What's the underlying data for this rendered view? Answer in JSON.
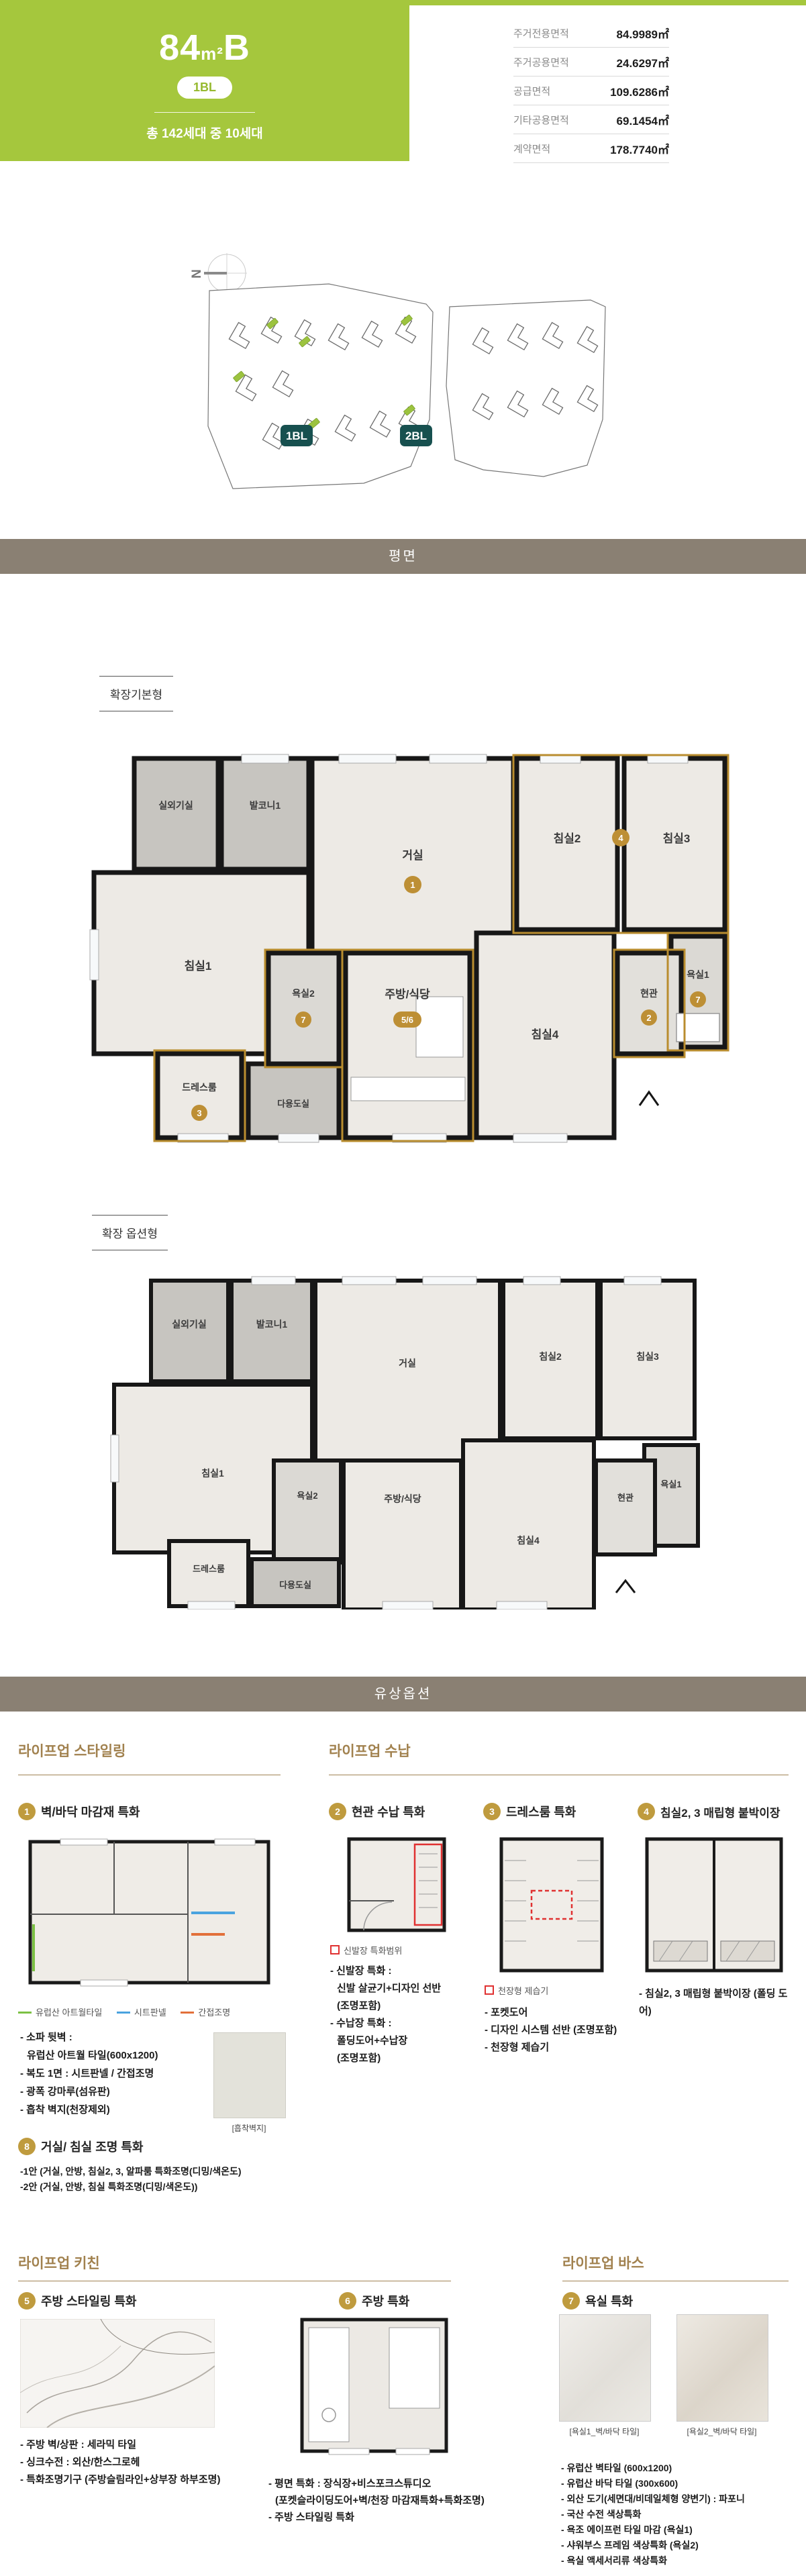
{
  "header": {
    "size": "84",
    "unit": "m²",
    "type": "B",
    "block_badge": "1BL",
    "units_text": "총 142세대 중 10세대",
    "area_table": [
      {
        "label": "주거전용면적",
        "value": "84.9989㎡"
      },
      {
        "label": "주거공용면적",
        "value": "24.6297㎡"
      },
      {
        "label": "공급면적",
        "value": "109.6286㎡"
      },
      {
        "label": "기타공용면적",
        "value": "69.1454㎡"
      },
      {
        "label": "계약면적",
        "value": "178.7740㎡"
      }
    ]
  },
  "site": {
    "north": "N",
    "block1": "1BL",
    "block2": "2BL"
  },
  "bars": {
    "plan": "평면",
    "options": "유상옵션"
  },
  "plans": {
    "basic_label": "확장기본형",
    "option_label": "확장 옵션형",
    "rooms": {
      "outdoor": "실외기실",
      "balcony1": "발코니1",
      "living": "거실",
      "bed1": "침실1",
      "bed2": "침실2",
      "bed3": "침실3",
      "bed4": "침실4",
      "bath1": "욕실1",
      "bath2": "욕실2",
      "kitchen": "주방/식당",
      "entry": "현관",
      "dress": "드레스룸",
      "utility": "다용도실"
    },
    "badges": {
      "living": "1",
      "bed23": "4",
      "bath": "7",
      "kitchen": "5/6",
      "entry": "2",
      "dress": "3"
    }
  },
  "colors": {
    "brand_green": "#a5c73d",
    "teal_badge": "#17504f",
    "bar_brown": "#8a8073",
    "gold_badge": "#bf9b3e",
    "gold_header": "#a1814e",
    "plan_outline_gold": "#b98d2f",
    "annotation_red": "#e03131",
    "legend_green": "#7cc144",
    "legend_blue": "#4aa3df",
    "legend_orange": "#e2703a"
  },
  "options": {
    "styling": {
      "header": "라이프업 스타일링",
      "item1": {
        "num": "1",
        "title": "벽/바닥 마감재 특화",
        "legend": [
          {
            "label": "유럽산 아트월타일"
          },
          {
            "label": "시트판넬"
          },
          {
            "label": "간접조명"
          }
        ],
        "bullets": [
          "- 소파 뒷벽 :",
          "유럽산 아트월 타일(600x1200)",
          "- 복도 1면 : 시트판넬 / 간접조명",
          "- 광폭 강마루(섬유판)",
          "- 흡착 벽지(천장제외)"
        ],
        "swatch_caption": "[흡착벽지]"
      },
      "item8": {
        "num": "8",
        "title": "거실/ 침실 조명 특화",
        "bullets": [
          "-1안 (거실, 안방, 침실2, 3, 알파룸 특화조명(디밍/색온도)",
          "-2안 (거실, 안방, 침실 특화조명(디밍/색온도))"
        ]
      }
    },
    "storage": {
      "header": "라이프업 수납",
      "item2": {
        "num": "2",
        "title": "현관 수납 특화",
        "legend": "신발장 특화범위",
        "bullets": [
          "- 신발장 특화 :",
          "신발 살균기+디자인 선반",
          "(조명포함)",
          "- 수납장 특화 :",
          "폴딩도어+수납장",
          "(조명포함)"
        ]
      },
      "item3": {
        "num": "3",
        "title": "드레스룸 특화",
        "legend": "천장형 제습기",
        "bullets": [
          "- 포켓도어",
          "- 디자인 시스템 선반 (조명포함)",
          "- 천장형 제습기"
        ]
      },
      "item4": {
        "num": "4",
        "title": "침실2, 3 매립형 붙박이장",
        "bullets": [
          "- 침실2, 3 매립형 붙박이장 (폴딩 도어)"
        ]
      }
    },
    "kitchen": {
      "header": "라이프업 키친",
      "item5": {
        "num": "5",
        "title": "주방 스타일링 특화",
        "bullets": [
          "- 주방 벽/상판 : 세라믹 타일",
          "- 싱크수전 : 외산/한스그로헤",
          "- 특화조명기구 (주방슬림라인+상부장 하부조명)"
        ]
      },
      "item6": {
        "num": "6",
        "title": "주방 특화",
        "bullets": [
          "- 평면 특화 : 장식장+비스포크스튜디오",
          "(포켓슬라이딩도어+벽/천장 마감재특화+특화조명)",
          "- 주방 스타일링 특화"
        ]
      }
    },
    "bath": {
      "header": "라이프업 바스",
      "item7": {
        "num": "7",
        "title": "욕실 특화",
        "captions": [
          "[욕실1_벽/바닥 타일]",
          "[욕실2_벽/바닥 타일]"
        ],
        "bullets": [
          "- 유럽산 벽타일 (600x1200)",
          "- 유럽산 바닥 타일 (300x600)",
          "- 외산 도기(세면대/비데일체형 양변기) : 파포니",
          "- 국산 수전 색상특화",
          "- 욕조 에이프런 타일 마감 (욕실1)",
          "- 샤워부스 프레임 색상특화 (욕실2)",
          "- 욕실 액세서리류 색상특화"
        ]
      }
    }
  }
}
